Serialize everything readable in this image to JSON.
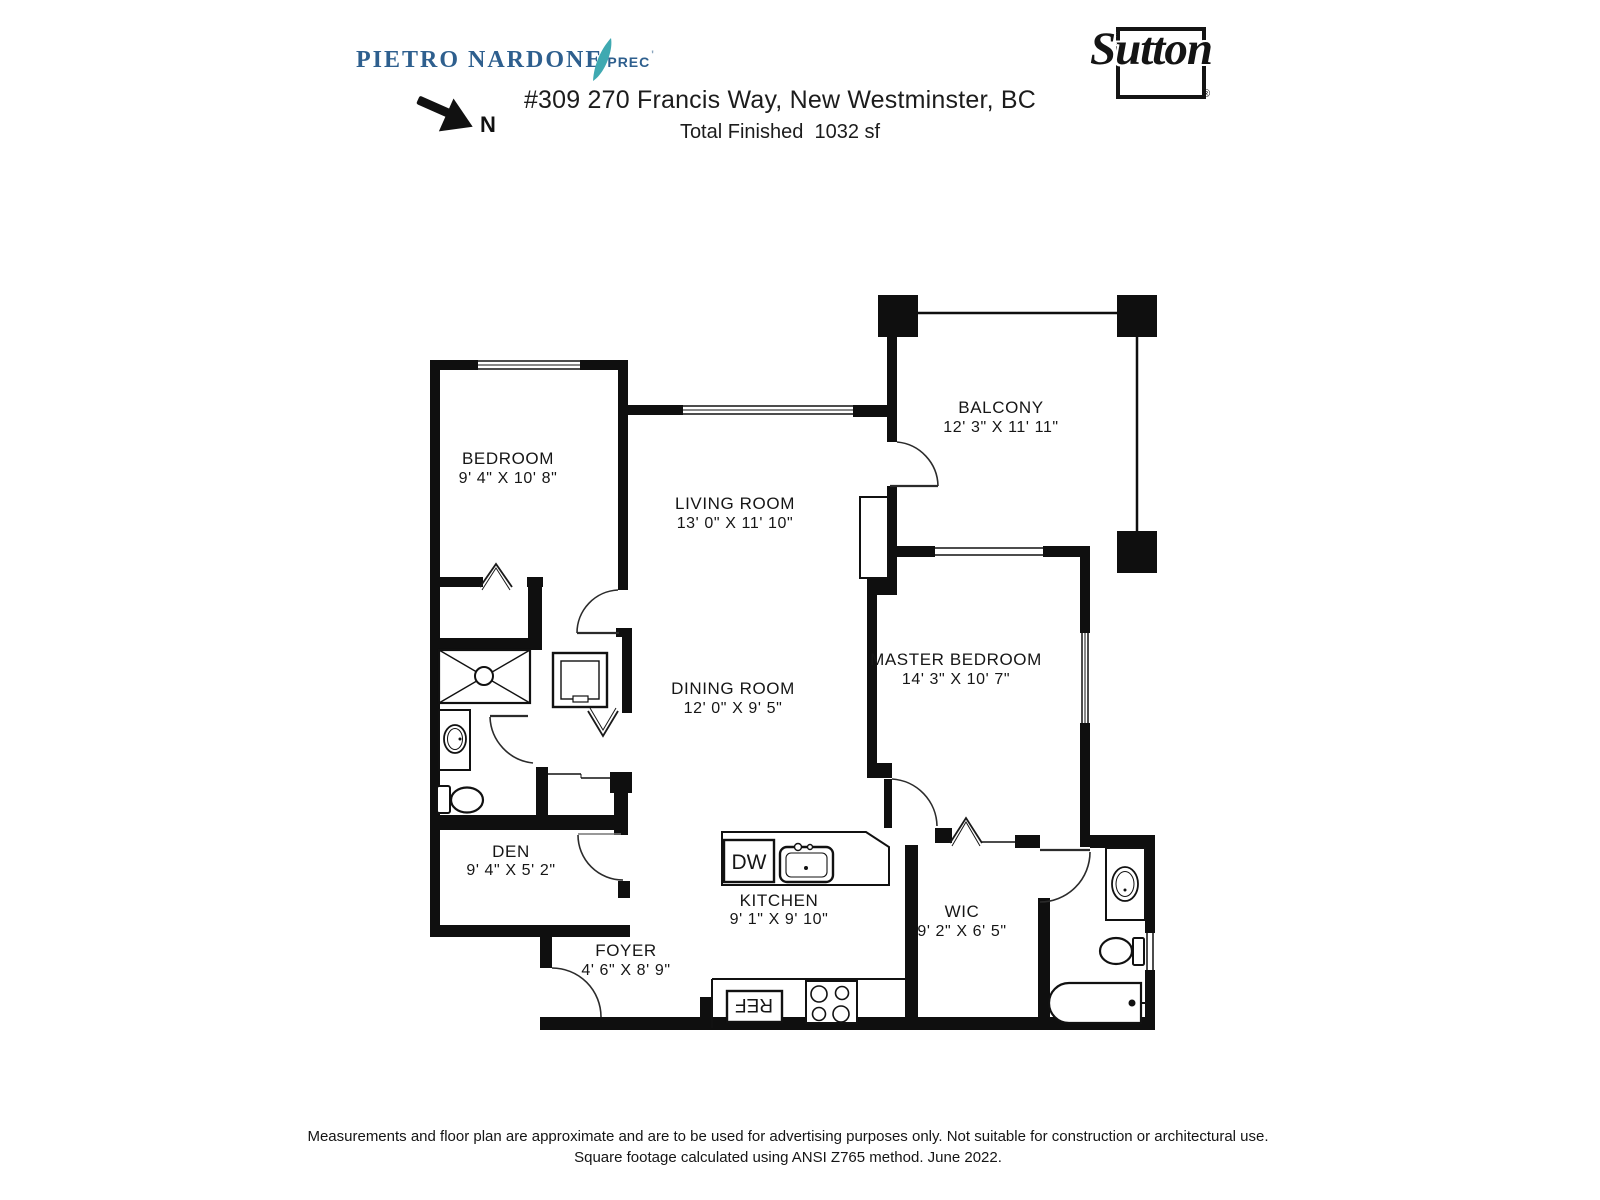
{
  "header": {
    "agent": {
      "name": "PIETRO NARDONE",
      "designation": "PREC",
      "tick": "'"
    },
    "north": {
      "label": "N"
    },
    "address": "#309 270 Francis Way, New Westminster, BC",
    "total_finished": "Total Finished  1032 sf",
    "brand": {
      "name": "Sutton",
      "registered": "®"
    }
  },
  "plan": {
    "rooms": {
      "bedroom": {
        "name": "BEDROOM",
        "dims": "9' 4\" X 10' 8\""
      },
      "living_room": {
        "name": "LIVING ROOM",
        "dims": "13' 0\" X 11' 10\""
      },
      "balcony": {
        "name": "BALCONY",
        "dims": "12' 3\" X 11' 11\""
      },
      "master_bedroom": {
        "name": "MASTER BEDROOM",
        "dims": "14' 3\" X 10' 7\""
      },
      "dining_room": {
        "name": "DINING ROOM",
        "dims": "12' 0\" X 9' 5\""
      },
      "den": {
        "name": "DEN",
        "dims": "9' 4\" X 5' 2\""
      },
      "kitchen": {
        "name": "KITCHEN",
        "dims": "9' 1\" X 9' 10\""
      },
      "wic": {
        "name": "WIC",
        "dims": "9' 2\" X 6' 5\""
      },
      "foyer": {
        "name": "FOYER",
        "dims": "4' 6\" X 8' 9\""
      }
    },
    "appliances": {
      "dishwasher": "DW",
      "refrigerator": "REF"
    }
  },
  "footer": {
    "line1": "Measurements and floor plan are approximate and are to be used for advertising purposes only. Not suitable for construction or architectural use.",
    "line2": "Square footage calculated using ANSI Z765 method. June 2022."
  },
  "colors": {
    "agent_blue": "#2e5f8e",
    "sail_teal": "#3fa9b1",
    "ink": "#111111"
  }
}
